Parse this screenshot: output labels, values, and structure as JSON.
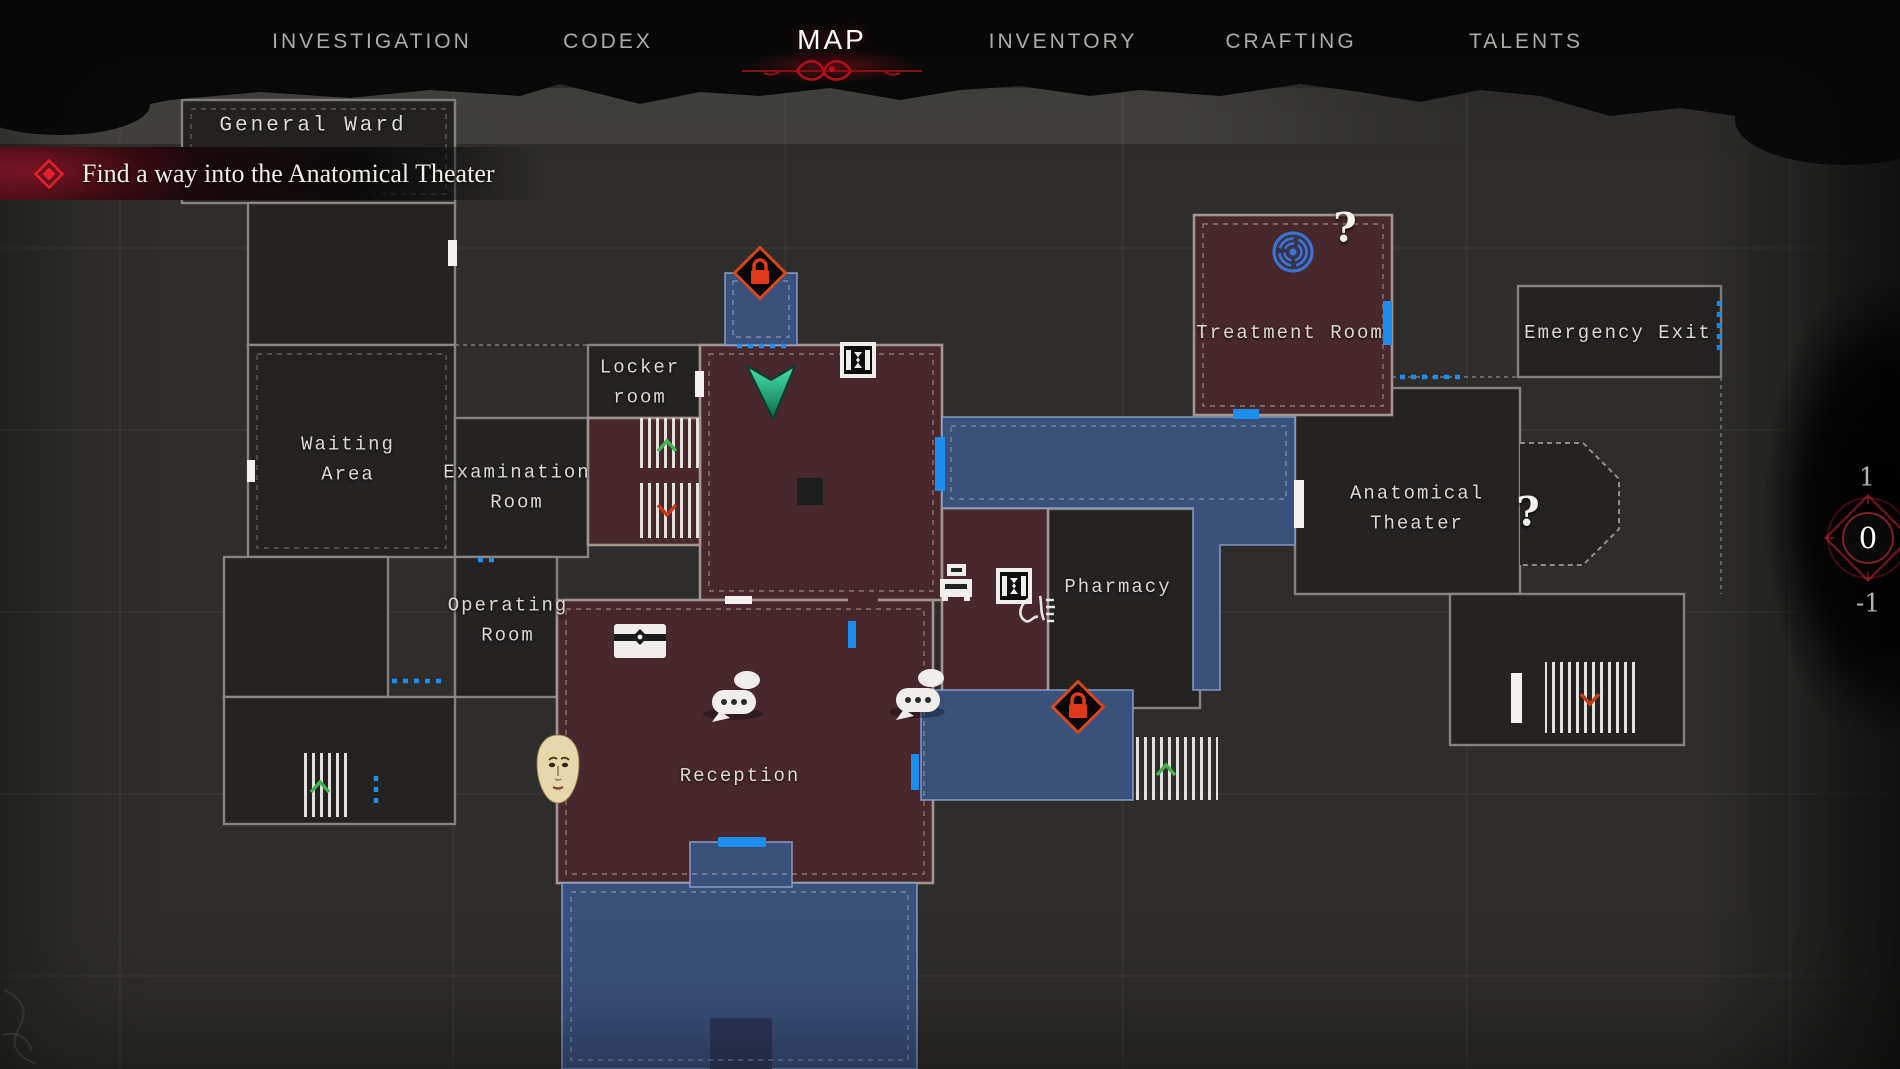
{
  "nav": {
    "tabs": [
      {
        "label": "INVESTIGATION",
        "active": false
      },
      {
        "label": "CODEX",
        "active": false
      },
      {
        "label": "MAP",
        "active": true
      },
      {
        "label": "INVENTORY",
        "active": false
      },
      {
        "label": "CRAFTING",
        "active": false
      },
      {
        "label": "TALENTS",
        "active": false
      }
    ]
  },
  "zone_label": "General Ward",
  "quest": {
    "icon": "objective-diamond-icon",
    "text": "Find a way into the Anatomical Theater"
  },
  "map": {
    "rooms": [
      {
        "name": "Waiting\nArea",
        "state": "unexplored"
      },
      {
        "name": "Examination\nRoom",
        "state": "unexplored"
      },
      {
        "name": "Locker\nroom",
        "state": "unexplored"
      },
      {
        "name": "Operating\nRoom",
        "state": "unexplored"
      },
      {
        "name": "Reception",
        "state": "explored"
      },
      {
        "name": "Pharmacy",
        "state": "unexplored"
      },
      {
        "name": "Treatment Room",
        "state": "explored"
      },
      {
        "name": "Emergency Exit",
        "state": "unexplored"
      },
      {
        "name": "Anatomical\nTheater",
        "state": "unexplored"
      }
    ],
    "unknown_markers": [
      "?",
      "?"
    ],
    "icons": {
      "player": "player-arrow",
      "locked_door": "padlock-diamond",
      "maze": "labyrinth-circle",
      "dialogue": "speech-bubbles",
      "citizen": "pale-face-portrait",
      "stash": "storage-chest",
      "register": "cash-register",
      "telephone": "hanging-telephone-sketch",
      "elevator": "gate-hourglass-square",
      "stairs_up": "green-chevron-up",
      "stairs_down": "red-chevron-down",
      "door_other_floor": "blue-bar",
      "door": "white-bar",
      "path_hint": "blue-dotted-line"
    },
    "colors": {
      "explored_room": "#48282c",
      "other_floor_room": "#3a517c",
      "unexplored_room": "#242322",
      "door_blue": "#1d8ef0",
      "locked_orange": "#d8481b",
      "lock_red": "#e0391a",
      "player_green": "#2fc98f",
      "stairs_up_green": "#43b052",
      "stairs_down_red": "#c03a1c",
      "maze_blue": "#3f74d4",
      "accent_red": "#c1121f"
    }
  },
  "floor_switcher": {
    "current": "0",
    "floors": [
      {
        "label": "1",
        "current": false
      },
      {
        "label": "0",
        "current": true
      },
      {
        "label": "-1",
        "current": false
      }
    ]
  }
}
